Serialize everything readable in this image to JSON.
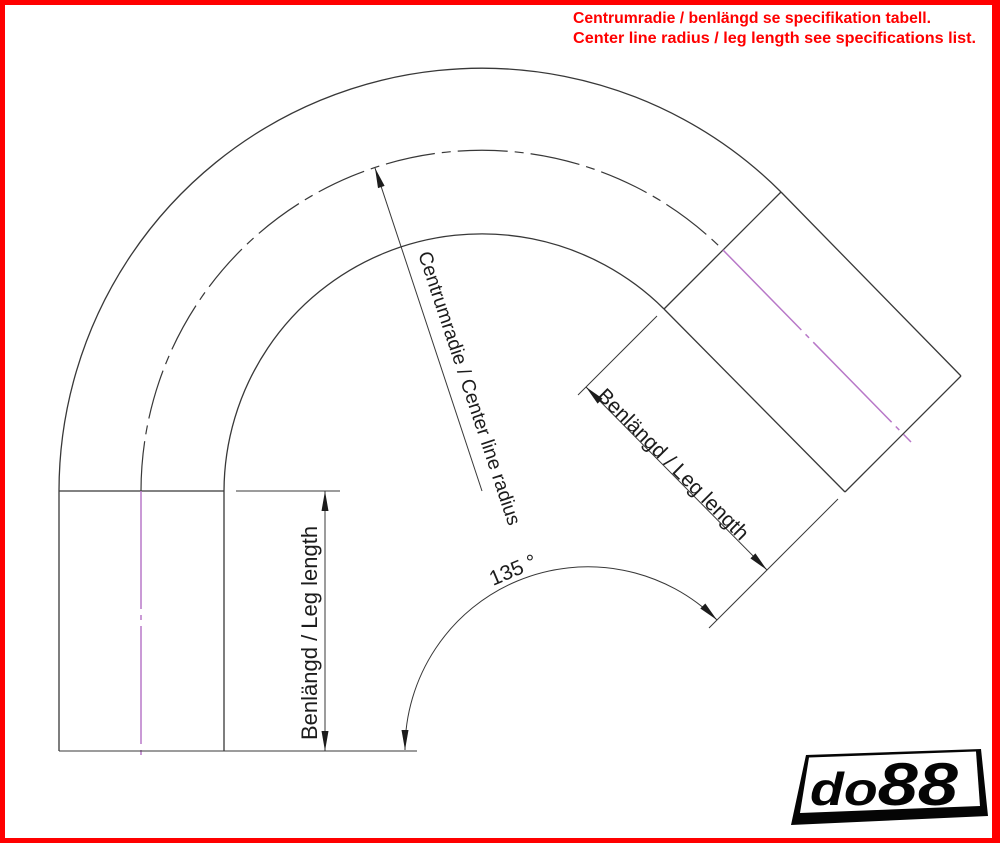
{
  "page": {
    "background": "#ffffff",
    "border_color": "#ff0000",
    "width_px": 1000,
    "height_px": 843
  },
  "note": {
    "line1": "Centrumradie / benlängd se specifikation tabell.",
    "line2": "Center line radius / leg length see specifications list.",
    "color": "#ff0000"
  },
  "drawing": {
    "type": "technical-dimension-diagram",
    "subject": "135-degree pipe elbow with two straight legs",
    "bend_angle_deg": 135,
    "labels": {
      "radius": "Centrumradie / Center line radius",
      "angle": "135 °",
      "left_leg": "Benlängd / Leg length",
      "right_leg": "Benlängd / Leg length"
    },
    "colors": {
      "outline": "#383838",
      "centerline_magenta": "#b878c8",
      "dimension_text": "#1c1c1c"
    }
  },
  "logo": {
    "part1": "do",
    "part2": "88",
    "color": "#050505"
  }
}
